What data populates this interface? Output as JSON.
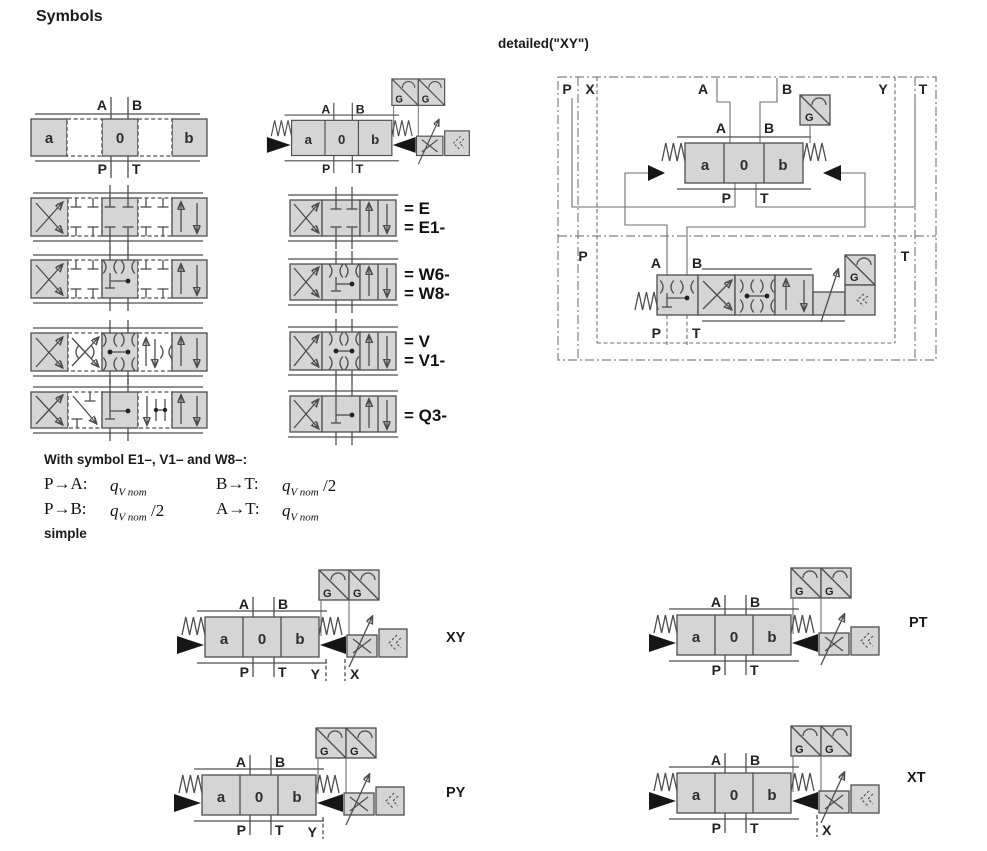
{
  "title": "Symbols",
  "detailed_heading": "detailed(\"XY\")",
  "valve": {
    "a": "a",
    "zero": "0",
    "b": "b",
    "A": "A",
    "B": "B",
    "P": "P",
    "T": "T",
    "G": "G",
    "Y": "Y",
    "X": "X"
  },
  "spool_labels": {
    "e": "= E",
    "e1": "= E1-",
    "w6": "= W6-",
    "w8": "= W8-",
    "v": "= V",
    "v1": "= V1-",
    "q3": "= Q3-"
  },
  "flow_note": {
    "heading": "With symbol E1–, V1– and W8–:",
    "simple_label": "simple",
    "rows": [
      {
        "lhs": "P→A:",
        "base": "q",
        "sub": "V nom",
        "suffix": ""
      },
      {
        "lhs": "B→T:",
        "base": "q",
        "sub": "V nom",
        "suffix": " /2"
      },
      {
        "lhs": "P→B:",
        "base": "q",
        "sub": "V nom",
        "suffix": " /2"
      },
      {
        "lhs": "A→T:",
        "base": "q",
        "sub": "V nom",
        "suffix": ""
      }
    ]
  },
  "variants": {
    "xy": "XY",
    "pt": "PT",
    "py": "PY",
    "xt": "XT"
  },
  "colors": {
    "box_fill": "#d5d5d5",
    "stroke": "#4d4d4d",
    "text": "#1a1a1a"
  }
}
